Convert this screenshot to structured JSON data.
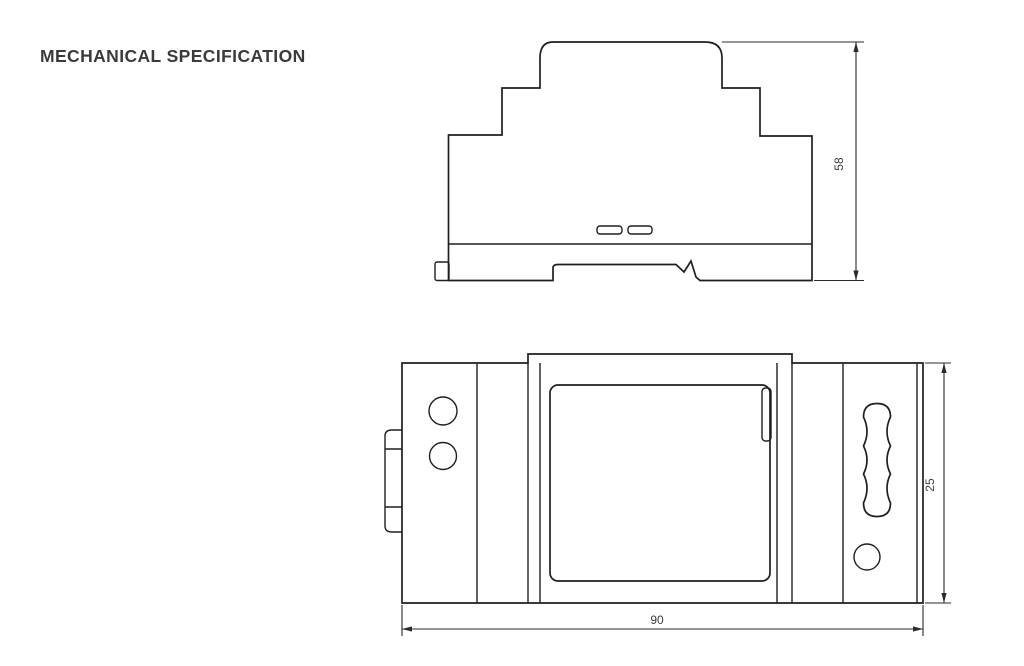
{
  "page": {
    "title": "MECHANICAL SPECIFICATION"
  },
  "views": {
    "side_view": {
      "name": "side profile with DIN rail base",
      "height_dim": "58"
    },
    "front_view": {
      "name": "front face with display window and DIN clip",
      "width_dim": "90",
      "depth_dim": "25"
    }
  },
  "colors": {
    "line": "#1f1f1f",
    "dim_text": "#3d3d3d",
    "title_text": "#3b3b3b",
    "background": "#ffffff"
  }
}
